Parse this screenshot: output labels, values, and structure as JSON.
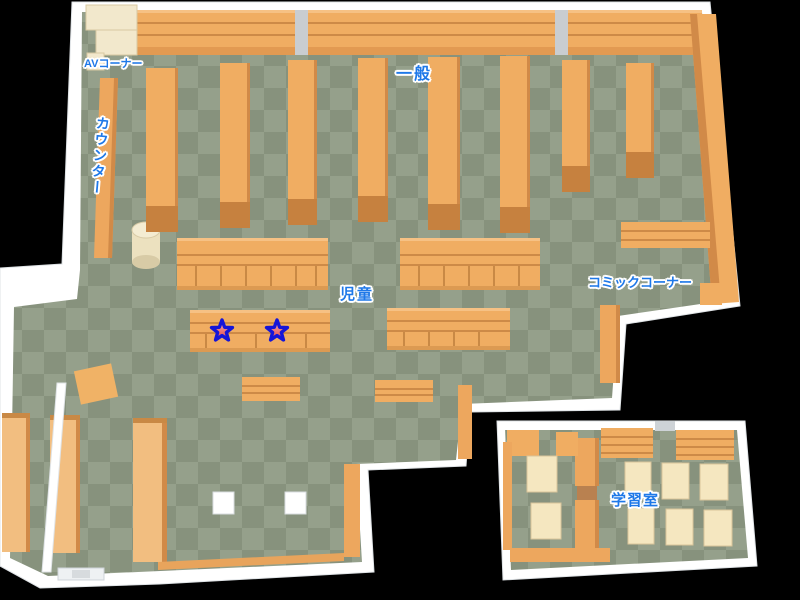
{
  "map": {
    "areas": {
      "av_corner": {
        "label": "AVコーナー"
      },
      "general": {
        "label": "一般"
      },
      "counter": {
        "label": "カウンター"
      },
      "children": {
        "label": "児童"
      },
      "comic_corner": {
        "label": "コミックコーナー"
      },
      "study_room": {
        "label": "学習室"
      }
    },
    "markers": {
      "stars": [
        {
          "x": 222,
          "y": 331
        },
        {
          "x": 277,
          "y": 331
        }
      ]
    },
    "colors": {
      "background": "#000000",
      "label_blue": "#1e78e8",
      "label_outline": "#ffffff",
      "floor_light": "#95a08b",
      "floor_dark": "#87927d",
      "shelf_orange": "#f0ad62",
      "shelf_edge": "#d18a48",
      "shelf_cap": "#c6813f",
      "wall_white": "#ffffff",
      "desk_cream": "#f2e8cc",
      "table_cream": "#f5e7c0",
      "star_fill_top": "#f8b4b4",
      "star_fill_bottom": "#e04545",
      "star_outline": "#1515d8"
    }
  }
}
